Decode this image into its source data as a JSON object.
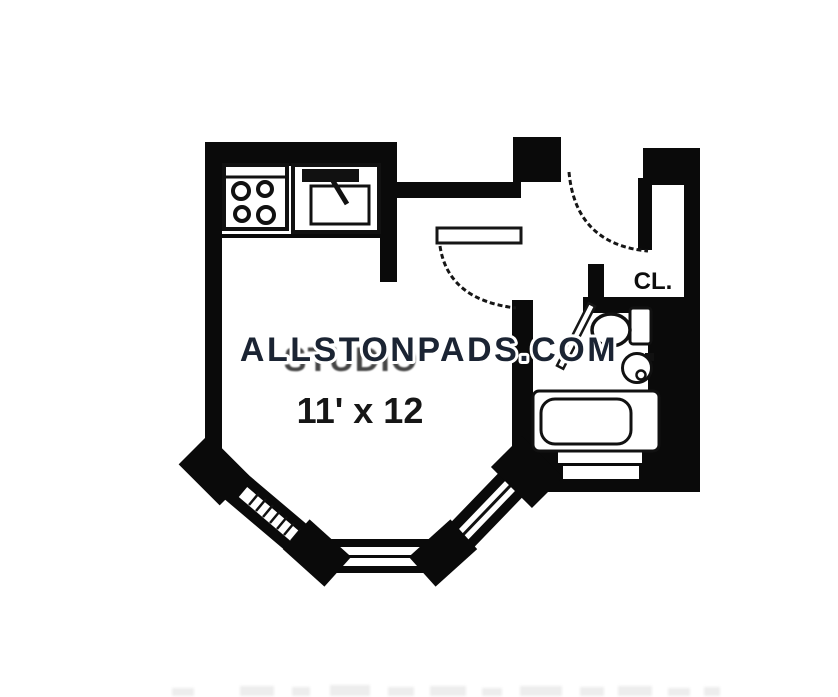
{
  "plan": {
    "watermark_text": "ALLSTONPADS.COM",
    "room": {
      "name": "STUDIO",
      "dimensions": "11' x 12"
    },
    "closet": {
      "label": "CL."
    },
    "colors": {
      "background": "#ffffff",
      "walls": "#0a0a0a",
      "fixture_outline": "#111111",
      "watermark": "#1b2433",
      "watermark_halo": "#ffffff"
    },
    "icons": {
      "stove": "stove-burners-icon",
      "kitchen_sink": "kitchen-sink-icon",
      "toilet": "toilet-icon",
      "bathroom_sink": "bathroom-sink-icon",
      "bathtub": "bathtub-icon",
      "entry_door": "door-swing-icon",
      "interior_door": "door-swing-icon",
      "bathroom_door": "door-leaf-icon",
      "bay_window": "bay-window-icon",
      "bathroom_window": "window-icon",
      "closet": "closet-icon"
    }
  }
}
